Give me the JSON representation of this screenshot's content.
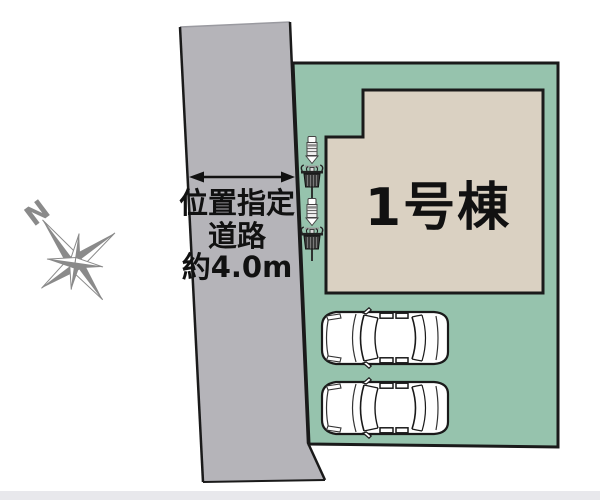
{
  "plan": {
    "building": {
      "label": "1号棟"
    },
    "road": {
      "label_lines": [
        "位置指定",
        "道路",
        "約4.0m"
      ]
    },
    "compass": {
      "north_label": "N"
    },
    "counts": {
      "cars": 2,
      "utility_poles": 2
    },
    "colors": {
      "road": "#b5b4b9",
      "plot": "#96c3ad",
      "building": "#dad1c2",
      "outline": "#1a1a1a",
      "compass": "#8a8a8a",
      "bottom_bar": "#e8e8ec",
      "car_fill": "#ffffff",
      "text": "#111111"
    }
  }
}
